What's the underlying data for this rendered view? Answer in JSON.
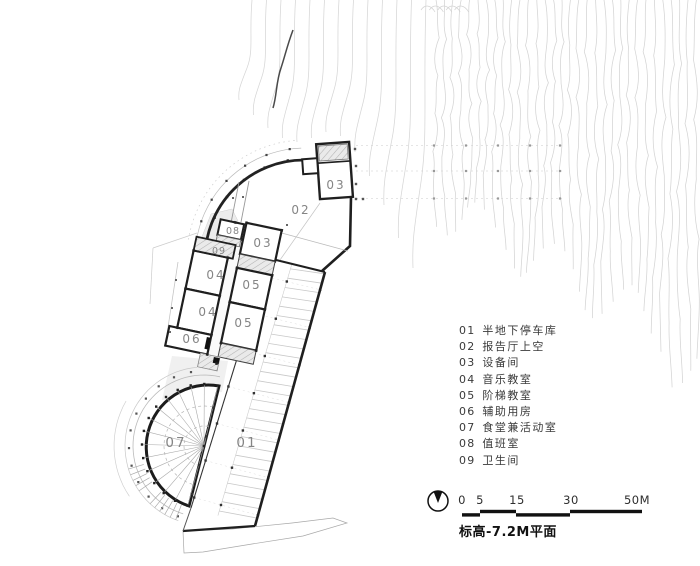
{
  "plan_title": "标高-7.2M平面",
  "legend": {
    "items": [
      {
        "num": "01",
        "label": "半地下停车库"
      },
      {
        "num": "02",
        "label": "报告厅上空"
      },
      {
        "num": "03",
        "label": "设备间"
      },
      {
        "num": "04",
        "label": "音乐教室"
      },
      {
        "num": "05",
        "label": "阶梯教室"
      },
      {
        "num": "06",
        "label": "辅助用房"
      },
      {
        "num": "07",
        "label": "食堂兼活动室"
      },
      {
        "num": "08",
        "label": "值班室"
      },
      {
        "num": "09",
        "label": "卫生间"
      }
    ]
  },
  "scale_bar": {
    "ticks": [
      "0",
      "5",
      "15",
      "30",
      "50M"
    ]
  },
  "room_labels": {
    "r01": "01",
    "r02": "02",
    "r03": "03",
    "r04": "04",
    "r05": "05",
    "r06": "06",
    "r07": "07",
    "r08": "08",
    "r09": "09"
  },
  "colors": {
    "wall": "#1f1f1f",
    "thin": "#999999",
    "contour": "#d4d4d4",
    "label_gray": "#858585"
  }
}
